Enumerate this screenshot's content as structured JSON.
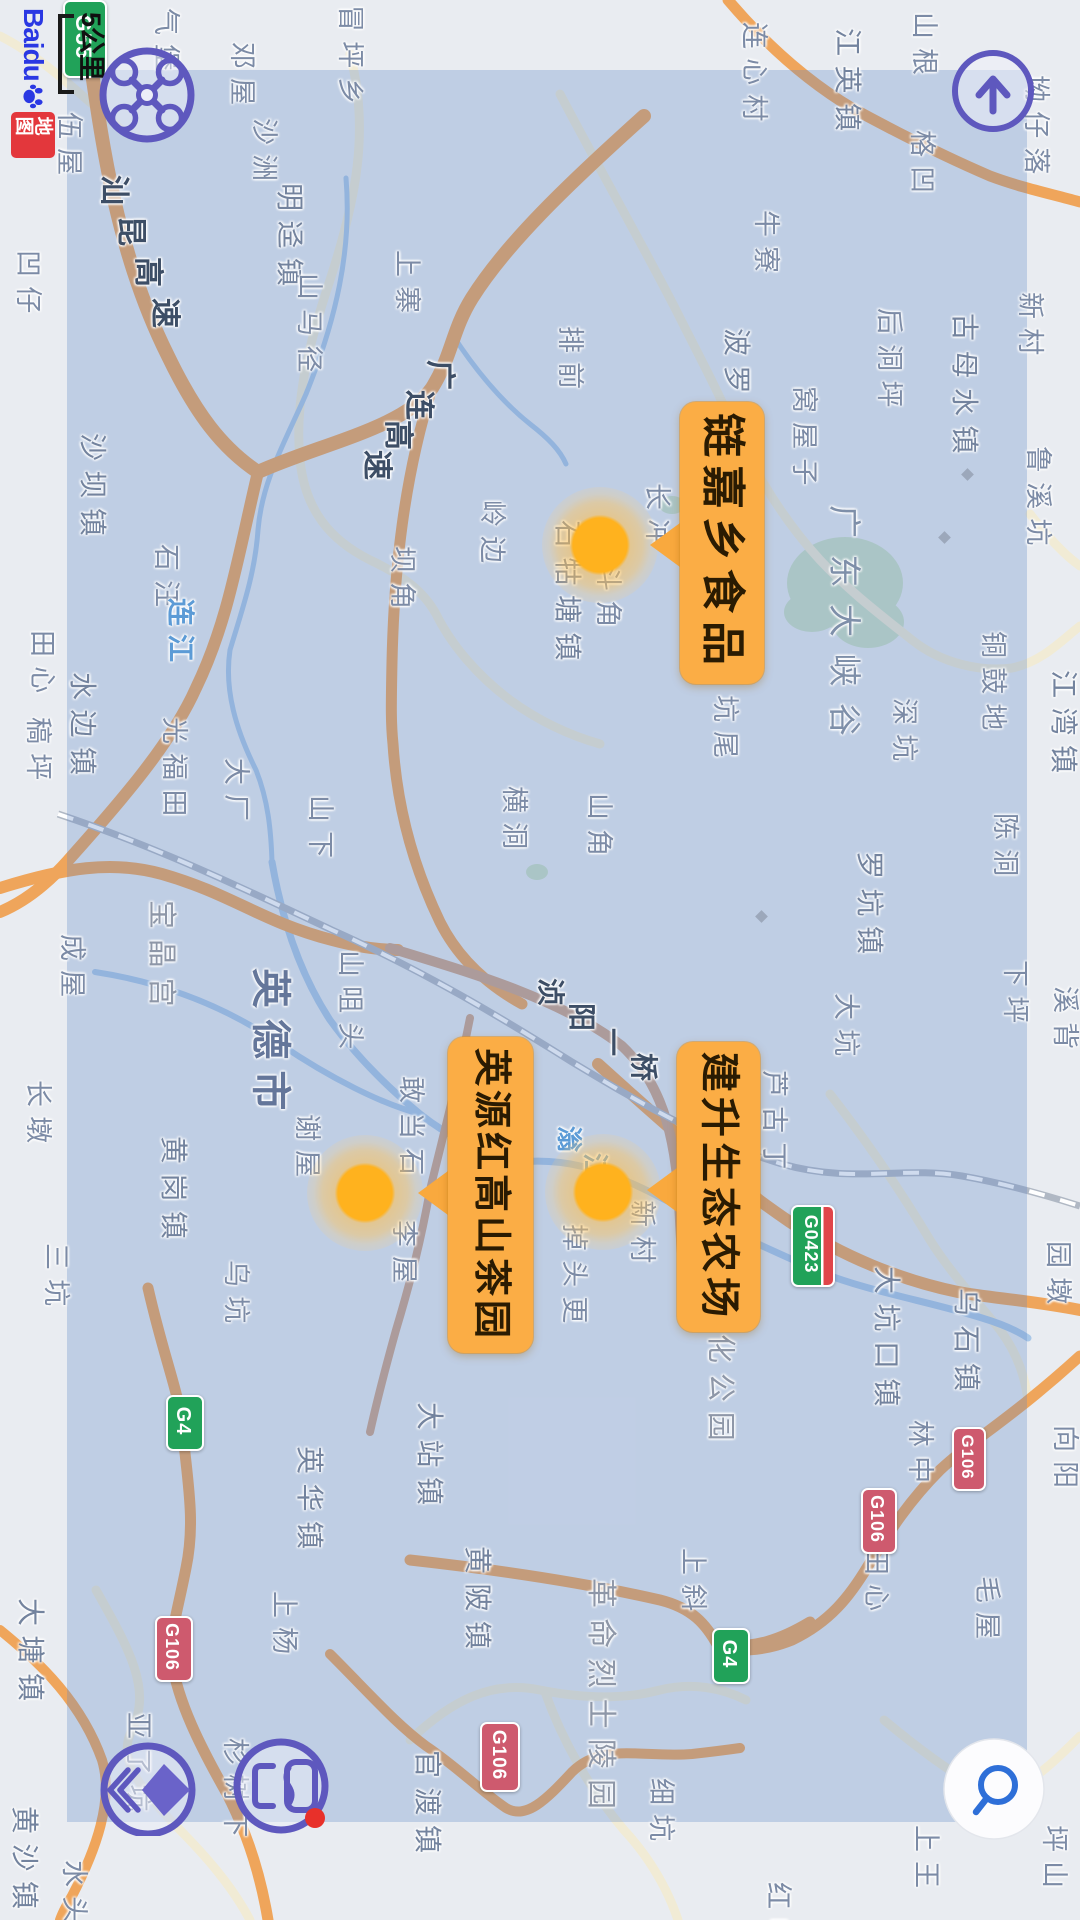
{
  "ui": {
    "logo": {
      "latin": "Baidu",
      "badge": "地图"
    },
    "scale": {
      "label": "5公里"
    },
    "accent": "#5E58BE",
    "buttons": [
      {
        "name": "drone-button",
        "icon": "drone-icon"
      },
      {
        "name": "compass-up-button",
        "icon": "up-arrow-icon"
      },
      {
        "name": "layers-button",
        "icon": "layers-diamond-icon"
      },
      {
        "name": "messages-button",
        "icon": "chat-frames-icon",
        "badge_color": "#E8302A"
      },
      {
        "name": "search-button",
        "icon": "search-icon"
      }
    ]
  },
  "map": {
    "markers": [
      {
        "label": "链嘉乡食品",
        "box": {
          "x": 680,
          "y": 402,
          "w": 84,
          "h": 282
        },
        "fs": 44,
        "ls": 8,
        "dot": {
          "x": 600,
          "y": 545
        },
        "tip_y": 545
      },
      {
        "label": "英源红高山茶园",
        "box": {
          "x": 448,
          "y": 1037,
          "w": 85,
          "h": 316
        },
        "fs": 38,
        "ls": 4,
        "dot": {
          "x": 365,
          "y": 1193
        },
        "tip_y": 1193
      },
      {
        "label": "建升生态农场",
        "box": {
          "x": 677,
          "y": 1042,
          "w": 83,
          "h": 290
        },
        "fs": 40,
        "ls": 5,
        "dot": {
          "x": 603,
          "y": 1192
        },
        "tip_y": 1190
      }
    ],
    "shields": [
      {
        "code": "G55",
        "kind": "expwy",
        "x": 63,
        "y": 0,
        "w": 40,
        "h": 74,
        "fs": 22
      },
      {
        "code": "G0423",
        "kind": "spur",
        "x": 791,
        "y": 1205,
        "w": 40,
        "h": 78,
        "fs": 18
      },
      {
        "code": "G4",
        "kind": "expwy",
        "x": 712,
        "y": 1628,
        "w": 34,
        "h": 52,
        "fs": 20
      },
      {
        "code": "G4",
        "kind": "expwy",
        "x": 166,
        "y": 1395,
        "w": 34,
        "h": 52,
        "fs": 20
      },
      {
        "code": "G106",
        "kind": "national",
        "x": 480,
        "y": 1722,
        "w": 36,
        "h": 66,
        "fs": 19
      },
      {
        "code": "G106",
        "kind": "national",
        "x": 952,
        "y": 1427,
        "w": 30,
        "h": 60,
        "fs": 17
      },
      {
        "code": "G106",
        "kind": "national",
        "x": 861,
        "y": 1488,
        "w": 32,
        "h": 62,
        "fs": 18
      },
      {
        "code": "G106",
        "kind": "national",
        "x": 155,
        "y": 1616,
        "w": 34,
        "h": 62,
        "fs": 18
      }
    ],
    "road_labels": [
      {
        "text": "汕昆高速",
        "x": 98,
        "y": 175,
        "dx": 17,
        "dy": 41,
        "fs": 30
      },
      {
        "text": "广连高速",
        "x": 424,
        "y": 360,
        "dx": -21,
        "dy": 30,
        "fs": 30
      },
      {
        "text": "浈阳一桥",
        "x": 536,
        "y": 978,
        "dx": 31,
        "dy": 25,
        "fs": 28
      }
    ],
    "water_labels": [
      {
        "text": "连江",
        "x": 166,
        "y": 598,
        "dx": 0,
        "dy": 36,
        "fs": 28
      },
      {
        "text": "滃江",
        "x": 556,
        "y": 1126,
        "dx": 26,
        "dy": 27,
        "fs": 26
      }
    ],
    "place_labels": [
      {
        "t": "冒坪乡",
        "x": 336,
        "y": 5
      },
      {
        "t": "邓屋",
        "x": 228,
        "y": 42
      },
      {
        "t": "气堡",
        "x": 152,
        "y": 8
      },
      {
        "t": "伍屋",
        "x": 55,
        "y": 112
      },
      {
        "t": "沙洲",
        "x": 250,
        "y": 118
      },
      {
        "t": "明迳镇",
        "x": 275,
        "y": 183,
        "cls": "town"
      },
      {
        "t": "凹仔",
        "x": 14,
        "y": 250
      },
      {
        "t": "山根",
        "x": 910,
        "y": 12
      },
      {
        "t": "连心村",
        "x": 740,
        "y": 22
      },
      {
        "t": "江英镇",
        "x": 833,
        "y": 28,
        "cls": "town"
      },
      {
        "t": "格凹",
        "x": 908,
        "y": 130
      },
      {
        "t": "坳仔落",
        "x": 1022,
        "y": 75
      },
      {
        "t": "牛寮",
        "x": 752,
        "y": 210
      },
      {
        "t": "上寨",
        "x": 393,
        "y": 250
      },
      {
        "t": "山马径",
        "x": 295,
        "y": 273
      },
      {
        "t": "排前",
        "x": 556,
        "y": 326
      },
      {
        "t": "波罗镇",
        "x": 722,
        "y": 328,
        "cls": "town"
      },
      {
        "t": "窝屋子",
        "x": 790,
        "y": 386
      },
      {
        "t": "后洞坪",
        "x": 875,
        "y": 308
      },
      {
        "t": "古母水镇",
        "x": 950,
        "y": 313,
        "cls": "town"
      },
      {
        "t": "新村",
        "x": 1016,
        "y": 292
      },
      {
        "t": "鲁溪坑",
        "x": 1024,
        "y": 446
      },
      {
        "t": "岭边",
        "x": 478,
        "y": 500
      },
      {
        "t": "石牯塘镇",
        "x": 553,
        "y": 520,
        "cls": "town"
      },
      {
        "t": "长冲",
        "x": 643,
        "y": 483
      },
      {
        "t": "坝角",
        "x": 388,
        "y": 546
      },
      {
        "t": "曹斗角",
        "x": 594,
        "y": 528
      },
      {
        "t": "深坑",
        "x": 890,
        "y": 698
      },
      {
        "t": "坑尾",
        "x": 711,
        "y": 695
      },
      {
        "t": "横洞",
        "x": 500,
        "y": 786
      },
      {
        "t": "山角",
        "x": 585,
        "y": 793
      },
      {
        "t": "铜鼓地",
        "x": 979,
        "y": 631
      },
      {
        "t": "江湾镇",
        "x": 1049,
        "y": 670,
        "cls": "town"
      },
      {
        "t": "罗坑镇",
        "x": 855,
        "y": 851,
        "cls": "town"
      },
      {
        "t": "陈洞",
        "x": 991,
        "y": 813
      },
      {
        "t": "下坪",
        "x": 1001,
        "y": 960
      },
      {
        "t": "大坑",
        "x": 832,
        "y": 993
      },
      {
        "t": "溪背",
        "x": 1051,
        "y": 986
      },
      {
        "t": "园墩",
        "x": 1044,
        "y": 1241
      },
      {
        "t": "乌石镇",
        "x": 952,
        "y": 1288,
        "cls": "town"
      },
      {
        "t": "大坑口镇",
        "x": 872,
        "y": 1266,
        "cls": "town"
      },
      {
        "t": "芦古丁",
        "x": 760,
        "y": 1070
      },
      {
        "t": "化公园",
        "x": 705,
        "y": 1334,
        "cls": "poi"
      },
      {
        "t": "新村",
        "x": 628,
        "y": 1200
      },
      {
        "t": "敢当石",
        "x": 397,
        "y": 1076
      },
      {
        "t": "李屋",
        "x": 390,
        "y": 1220
      },
      {
        "t": "山咀头",
        "x": 336,
        "y": 950
      },
      {
        "t": "英德市",
        "x": 250,
        "y": 968,
        "cls": "city"
      },
      {
        "t": "宝晶宫",
        "x": 146,
        "y": 900,
        "cls": "poi"
      },
      {
        "t": "成屋",
        "x": 58,
        "y": 934
      },
      {
        "t": "谢屋",
        "x": 293,
        "y": 1114
      },
      {
        "t": "黄岗镇",
        "x": 159,
        "y": 1136,
        "cls": "town"
      },
      {
        "t": "长墩",
        "x": 24,
        "y": 1080
      },
      {
        "t": "三坑",
        "x": 42,
        "y": 1243
      },
      {
        "t": "乌坑",
        "x": 222,
        "y": 1260
      },
      {
        "t": "石汪",
        "x": 152,
        "y": 544
      },
      {
        "t": "水边镇",
        "x": 68,
        "y": 672,
        "cls": "town"
      },
      {
        "t": "光福田",
        "x": 160,
        "y": 717
      },
      {
        "t": "大厂",
        "x": 222,
        "y": 758
      },
      {
        "t": "山下",
        "x": 306,
        "y": 795
      },
      {
        "t": "沙坝镇",
        "x": 78,
        "y": 433,
        "cls": "town"
      },
      {
        "t": "田心",
        "x": 28,
        "y": 630
      },
      {
        "t": "稿坪",
        "x": 24,
        "y": 717
      },
      {
        "t": "大塘镇",
        "x": 16,
        "y": 1598,
        "cls": "town"
      },
      {
        "t": "黄沙镇",
        "x": 10,
        "y": 1806,
        "cls": "town"
      },
      {
        "t": "亚了坑",
        "x": 124,
        "y": 1712
      },
      {
        "t": "杉树下",
        "x": 221,
        "y": 1738
      },
      {
        "t": "水头",
        "x": 60,
        "y": 1860
      },
      {
        "t": "上杨",
        "x": 270,
        "y": 1591
      },
      {
        "t": "英华镇",
        "x": 295,
        "y": 1446,
        "cls": "town"
      },
      {
        "t": "大站镇",
        "x": 415,
        "y": 1402,
        "cls": "town"
      },
      {
        "t": "黄陂镇",
        "x": 463,
        "y": 1546,
        "cls": "town"
      },
      {
        "t": "革命烈士陵园",
        "x": 585,
        "y": 1578,
        "cls": "poi",
        "fs": 30
      },
      {
        "t": "官渡镇",
        "x": 413,
        "y": 1750,
        "cls": "town"
      },
      {
        "t": "细坑",
        "x": 647,
        "y": 1778
      },
      {
        "t": "上斜",
        "x": 679,
        "y": 1548
      },
      {
        "t": "掉头更",
        "x": 560,
        "y": 1224
      },
      {
        "t": "林中",
        "x": 906,
        "y": 1420
      },
      {
        "t": "向阳",
        "x": 1051,
        "y": 1425
      },
      {
        "t": "田心",
        "x": 862,
        "y": 1548
      },
      {
        "t": "毛屋",
        "x": 973,
        "y": 1576
      },
      {
        "t": "上王",
        "x": 912,
        "y": 1825
      },
      {
        "t": "坪山",
        "x": 1040,
        "y": 1825
      },
      {
        "t": "红峰",
        "x": 764,
        "y": 1882
      },
      {
        "t": "广东大峡谷",
        "x": 828,
        "y": 505,
        "cls": "scenic"
      }
    ],
    "small_pois": [
      {
        "x": 963,
        "y": 470
      },
      {
        "x": 940,
        "y": 533
      },
      {
        "x": 757,
        "y": 912
      }
    ]
  }
}
